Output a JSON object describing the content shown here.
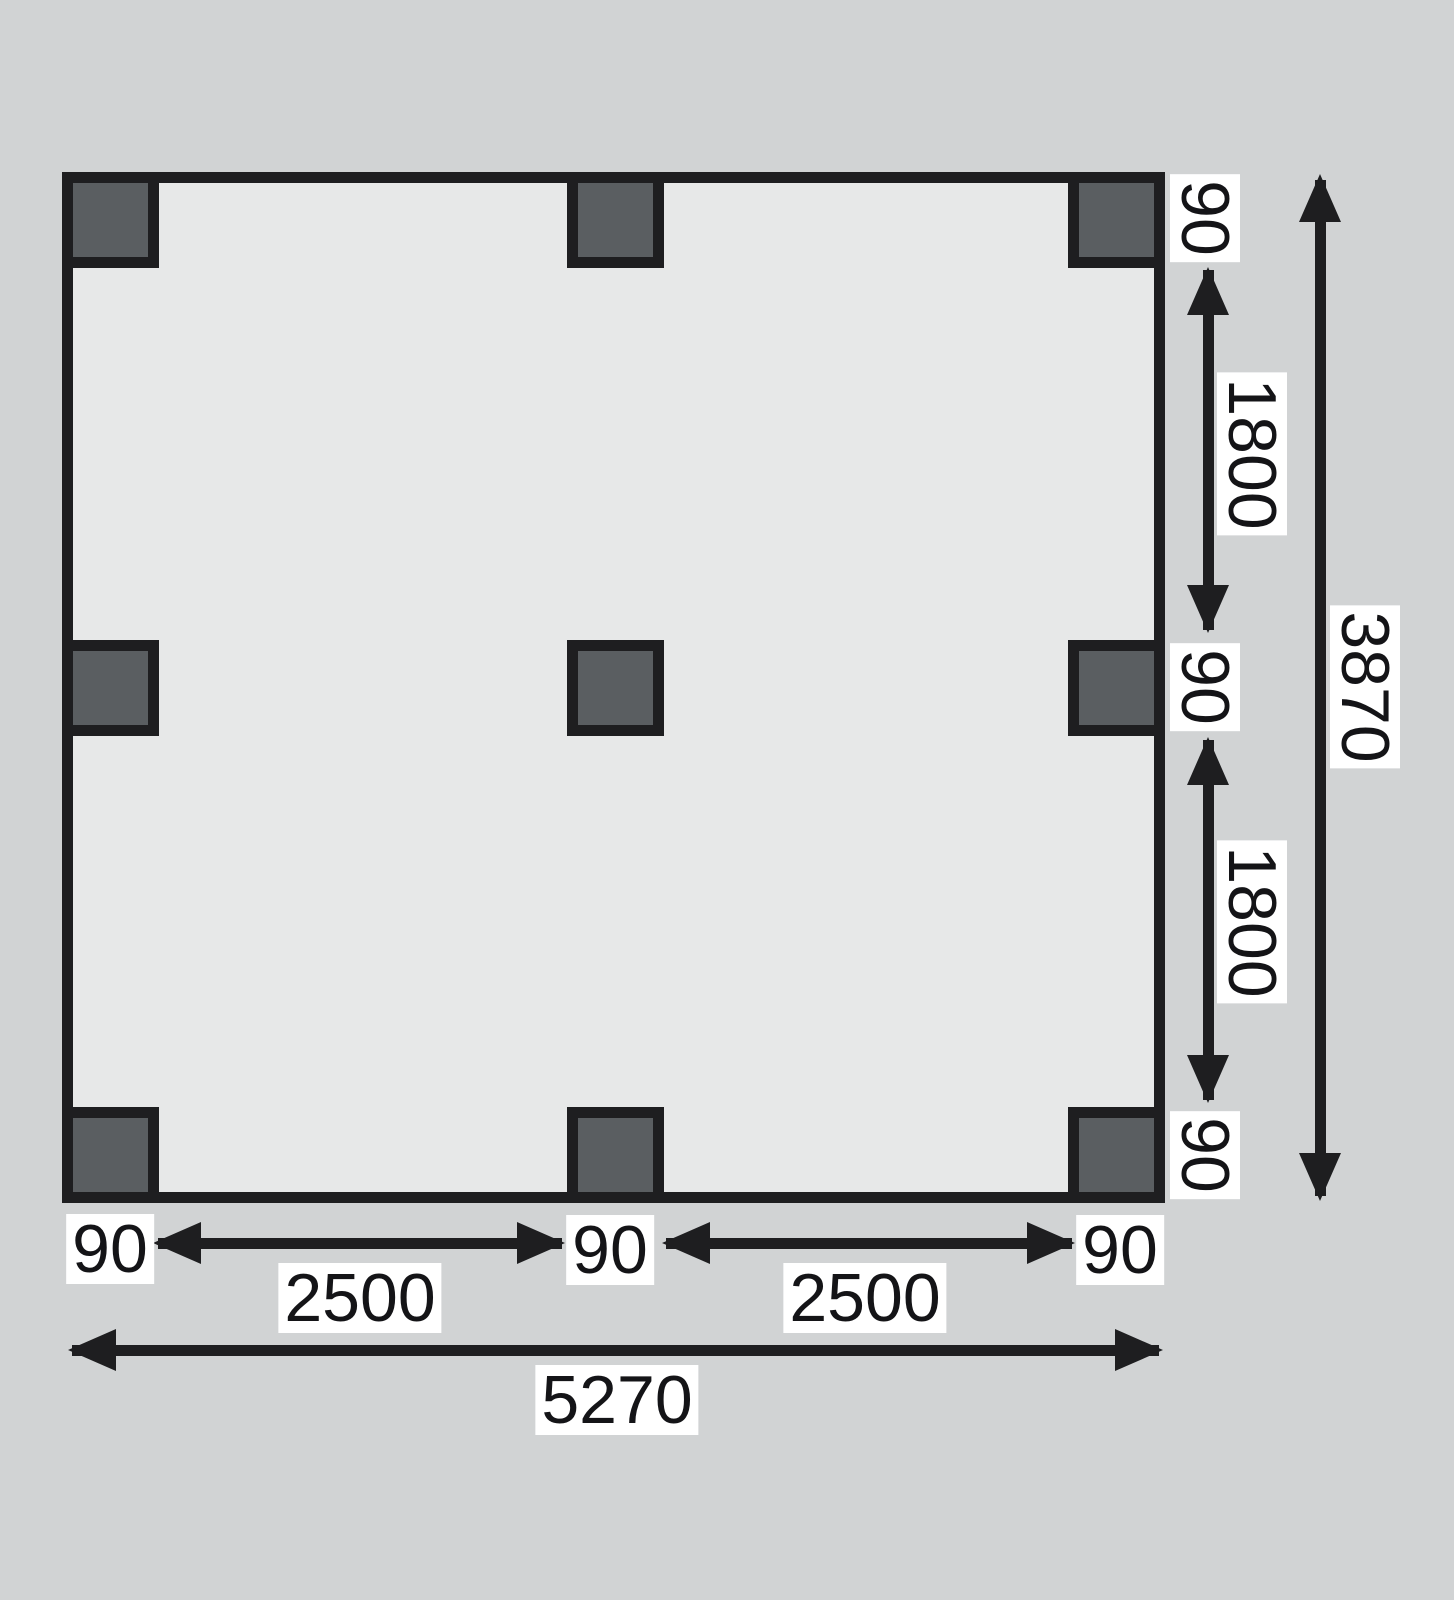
{
  "diagram": {
    "type": "floor-plan-dimension-drawing",
    "posts": {
      "count": 9,
      "rows": 3,
      "cols": 3
    },
    "bottom_chain": {
      "left_90": "90",
      "seg1": "2500",
      "mid_90": "90",
      "seg2": "2500",
      "right_90": "90",
      "total": "5270"
    },
    "right_chain": {
      "top_90": "90",
      "seg1": "1800",
      "mid_90": "90",
      "seg2": "1800",
      "bottom_90": "90",
      "total": "3870"
    },
    "colors": {
      "canvas_bg": "#d1d3d4",
      "floor_fill": "#e7e8e8",
      "post_fill": "#5a5e61",
      "line": "#1e1e20",
      "label_bg": "#ffffff",
      "label_text": "#141417"
    }
  }
}
